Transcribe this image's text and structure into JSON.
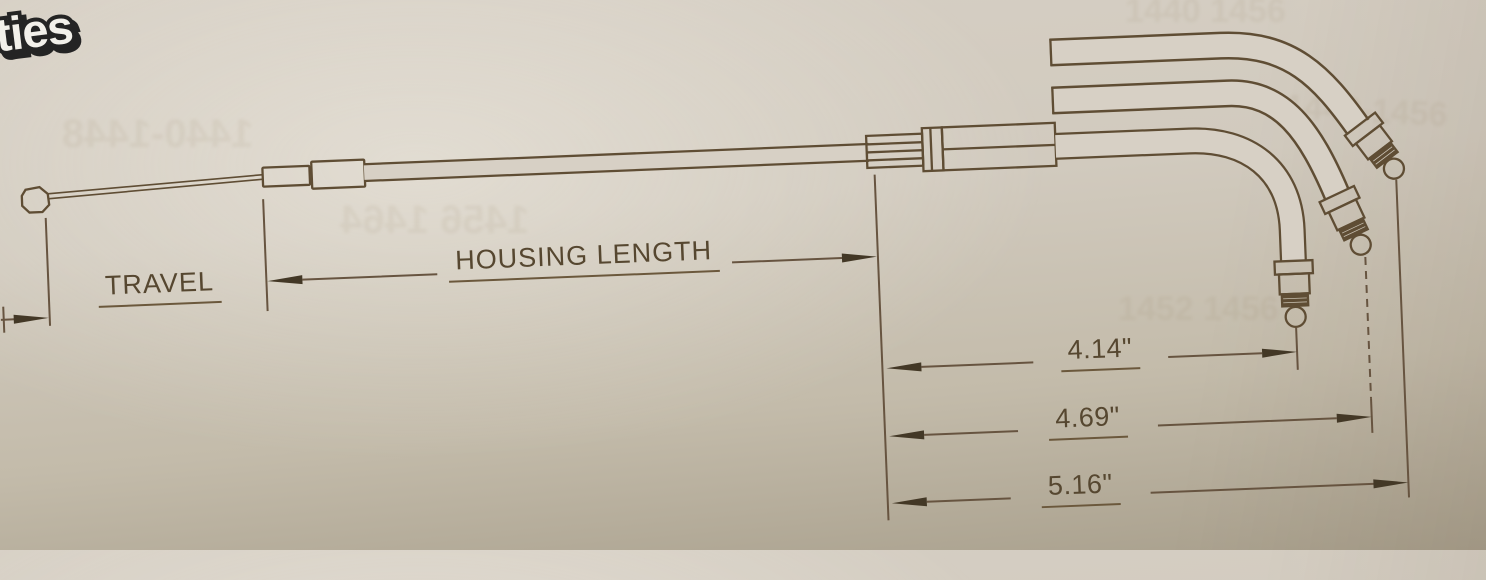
{
  "logo": {
    "text": "ties",
    "blue_accent_color": "#3a7bd0"
  },
  "labels": {
    "travel": "TRAVEL",
    "housing_length": "HOUSING LENGTH"
  },
  "dimensions": [
    {
      "id": "dim-4-14",
      "value": "4.14\""
    },
    {
      "id": "dim-4-69",
      "value": "4.69\""
    },
    {
      "id": "dim-5-16",
      "value": "5.16\""
    }
  ],
  "watermarks": [
    "1440 1456",
    "1448-1456",
    "1456 1464",
    "1440-1448",
    "1452 1456"
  ],
  "colors": {
    "paper": "#d7d0c5",
    "line": "#5f4d34",
    "arrow": "#433826",
    "text": "#564730",
    "logo_blue": "#3a7bd0"
  }
}
